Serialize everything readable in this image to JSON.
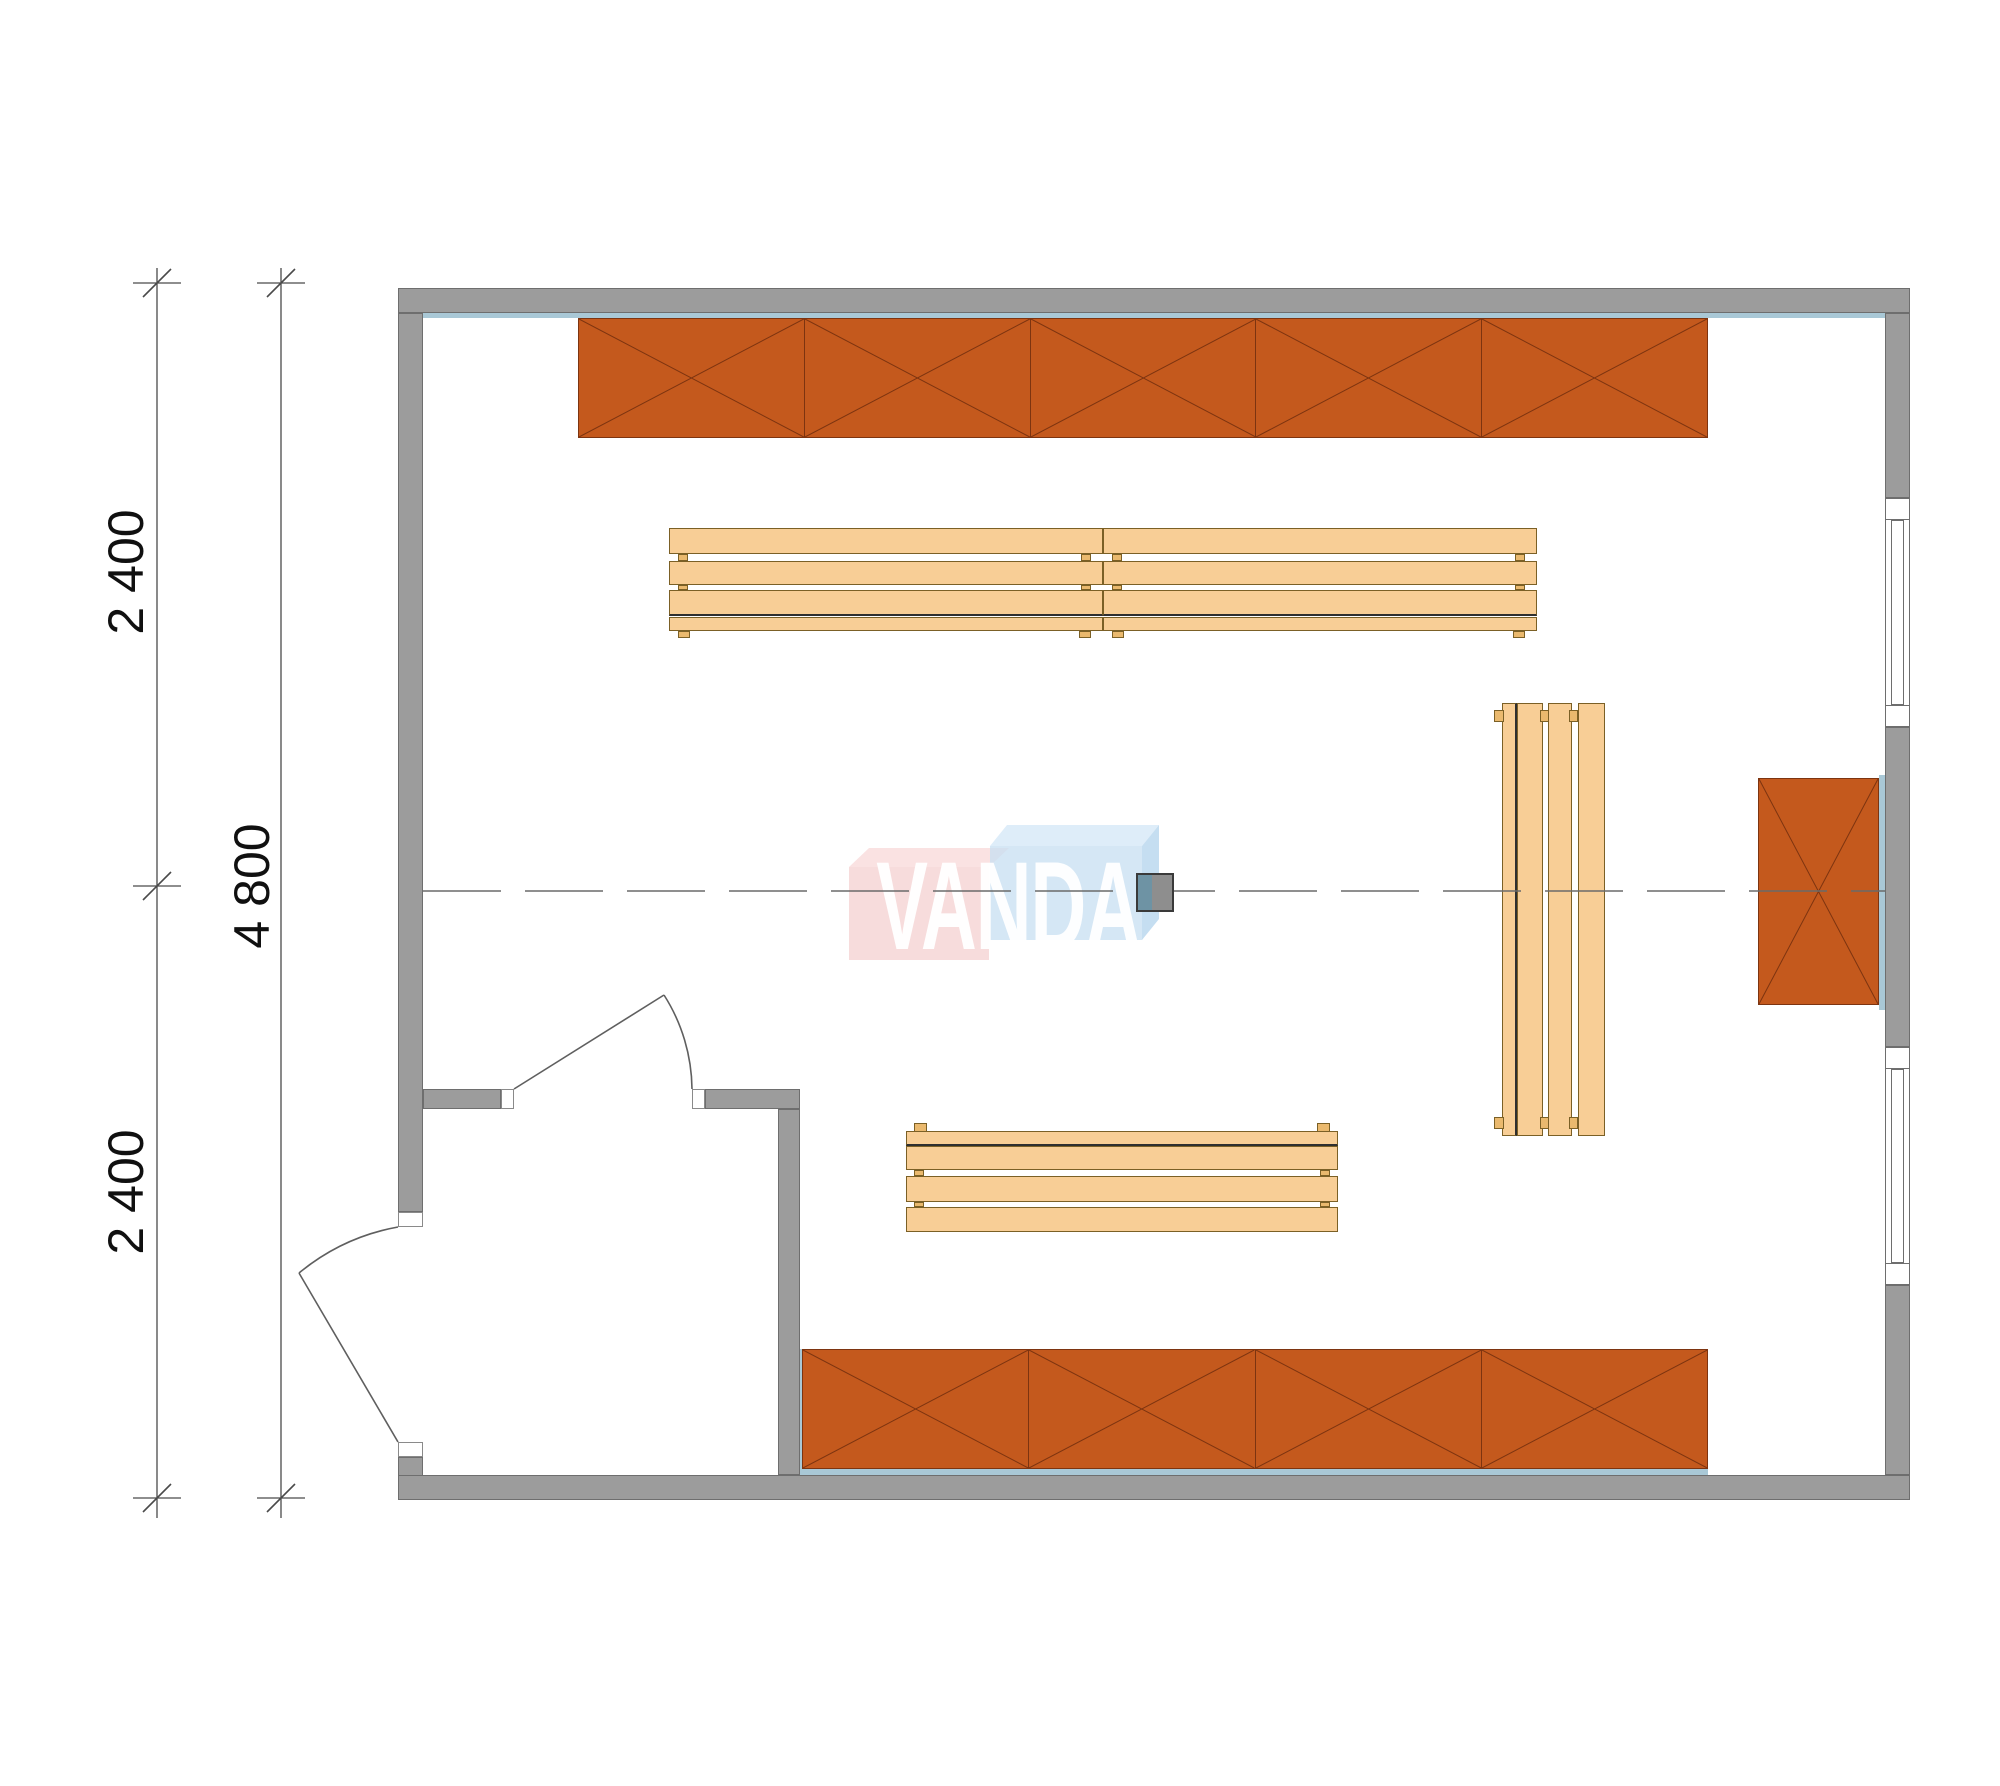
{
  "watermark": {
    "text": "VANDA",
    "pink_color": "#f3c9c9",
    "blue_color": "#c3dcf0"
  },
  "dimensions": {
    "segment_top": "2 400",
    "segment_bottom": "2 400",
    "total": "4 800"
  },
  "plan": {
    "type": "sauna room floor plan, top view",
    "colors": {
      "wall_gray": "#9c9c9c",
      "shelf_orange": "#c4591d",
      "shelf_cross_line": "#7d3410",
      "bench_wood": "#f8ce96",
      "bench_edge": "#7b6026",
      "accent_blue": "#a9c8d6",
      "heater_blue": "#6e93a4",
      "heater_gray": "#8e8e8e",
      "dimension_line": "#4a4a4a"
    },
    "furniture_counts": {
      "top_shelf_sections": 5,
      "bottom_shelf_sections": 4,
      "right_shelf_sections": 1,
      "benches": 3,
      "windows": 2,
      "doors": 2
    }
  }
}
